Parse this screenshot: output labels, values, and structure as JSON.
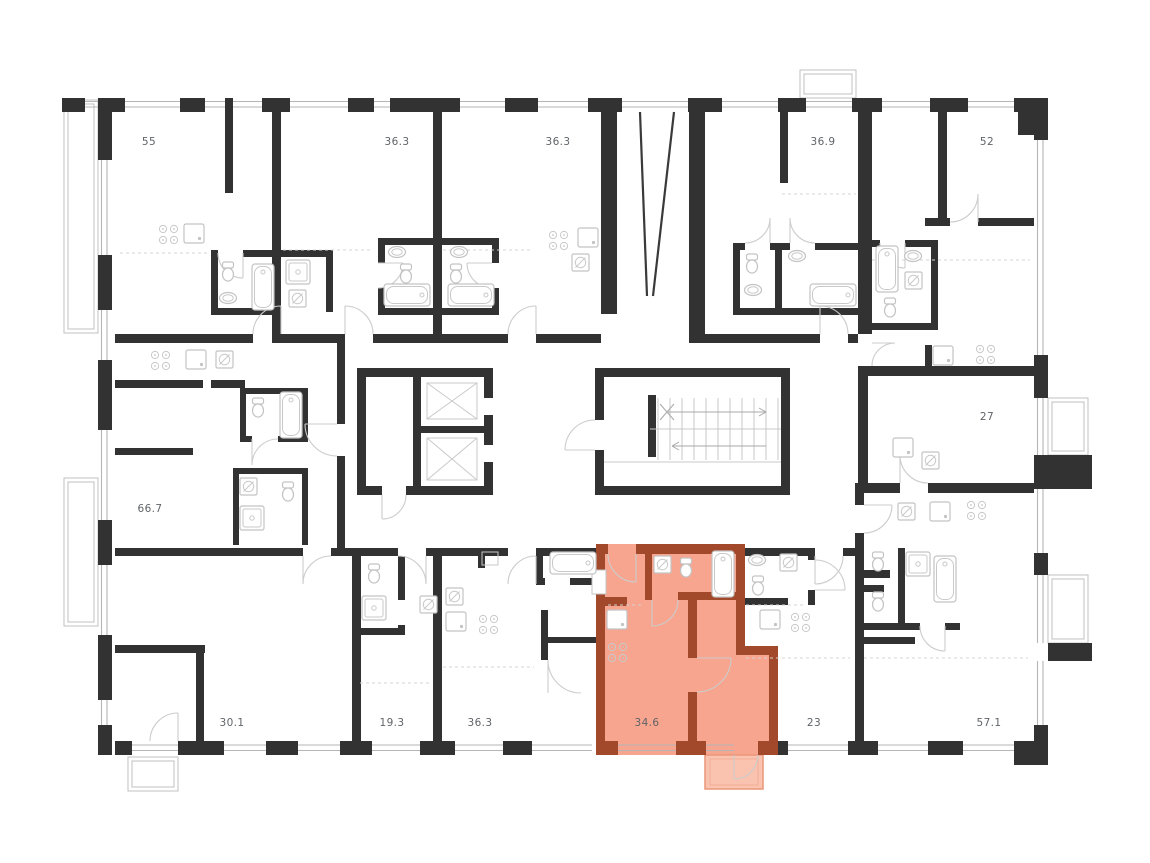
{
  "title": "Floor plan with highlighted apartment",
  "colors": {
    "wall": "#323232",
    "fixture": "#c3c3c3",
    "highlight_fill": "#F7A58F",
    "highlight_wall": "#A3492B",
    "balcony_fill": "#F9C3AF",
    "balcony_stroke": "#EA9679",
    "label": "#5F6468"
  },
  "units": [
    {
      "id": "unit-55",
      "area": "55"
    },
    {
      "id": "unit-36-3-top-left",
      "area": "36.3"
    },
    {
      "id": "unit-36-3-top-right",
      "area": "36.3"
    },
    {
      "id": "unit-36-9",
      "area": "36.9"
    },
    {
      "id": "unit-52",
      "area": "52"
    },
    {
      "id": "unit-66-7",
      "area": "66.7"
    },
    {
      "id": "unit-27",
      "area": "27"
    },
    {
      "id": "unit-30-1",
      "area": "30.1"
    },
    {
      "id": "unit-19-3",
      "area": "19.3"
    },
    {
      "id": "unit-36-3-bottom",
      "area": "36.3"
    },
    {
      "id": "unit-34-6",
      "area": "34.6",
      "highlighted": true
    },
    {
      "id": "unit-23",
      "area": "23"
    },
    {
      "id": "unit-57-1",
      "area": "57.1"
    }
  ]
}
